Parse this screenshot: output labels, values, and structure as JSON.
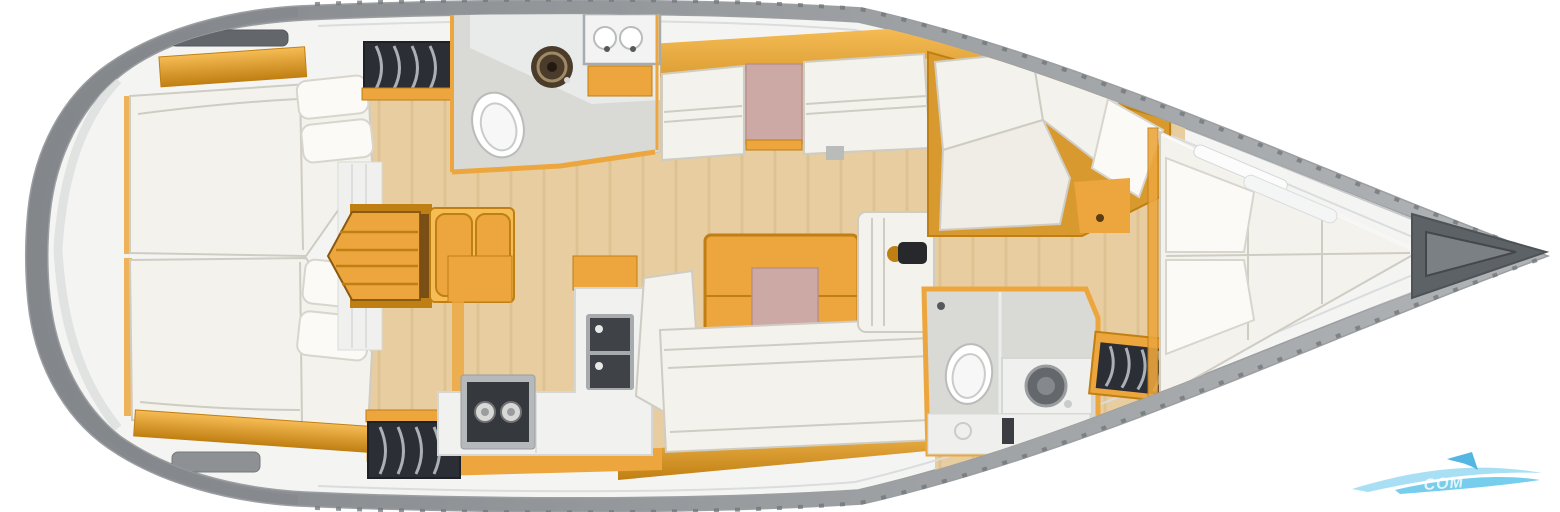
{
  "watermark": {
    "text": "COM",
    "color": "#49bce6"
  },
  "palette": {
    "bg": "#ffffff",
    "hull": "#b0b4b6",
    "hull-dark": "#83878b",
    "hull-edge": "#9b9fa2",
    "deck": "#f4f5f3",
    "deck-line": "#c7cacb",
    "deck-line-light": "#dadcdd",
    "tick": "#6f7478",
    "floor": "#e7cda0",
    "floor-streak": "#d8b886",
    "amber": "#eca63d",
    "amber-light": "#f6bc55",
    "amber-dark": "#c07f12",
    "amber-deep": "#8a5a10",
    "cushion": "#f4f2ec",
    "cushion-hi": "#fbfaf6",
    "cushion-line": "#cfccc3",
    "pink": "#cda9a6",
    "pink-dark": "#b98f8c",
    "slat-bg": "#2b2f35",
    "slat-line": "#b9bfc6",
    "gray-floor": "#d9dad6",
    "appliance": "#35383c",
    "metal": "#a7abad",
    "hatch": "#63676b",
    "hatch-light": "#8d9194",
    "basin": "#4a3b2b",
    "basin-ring": "#a08a64",
    "anchor": "#5d6266",
    "anchor-inner": "#7b8084",
    "wm-blue": "#9fdcf4",
    "wm-blue2": "#49bce6"
  }
}
